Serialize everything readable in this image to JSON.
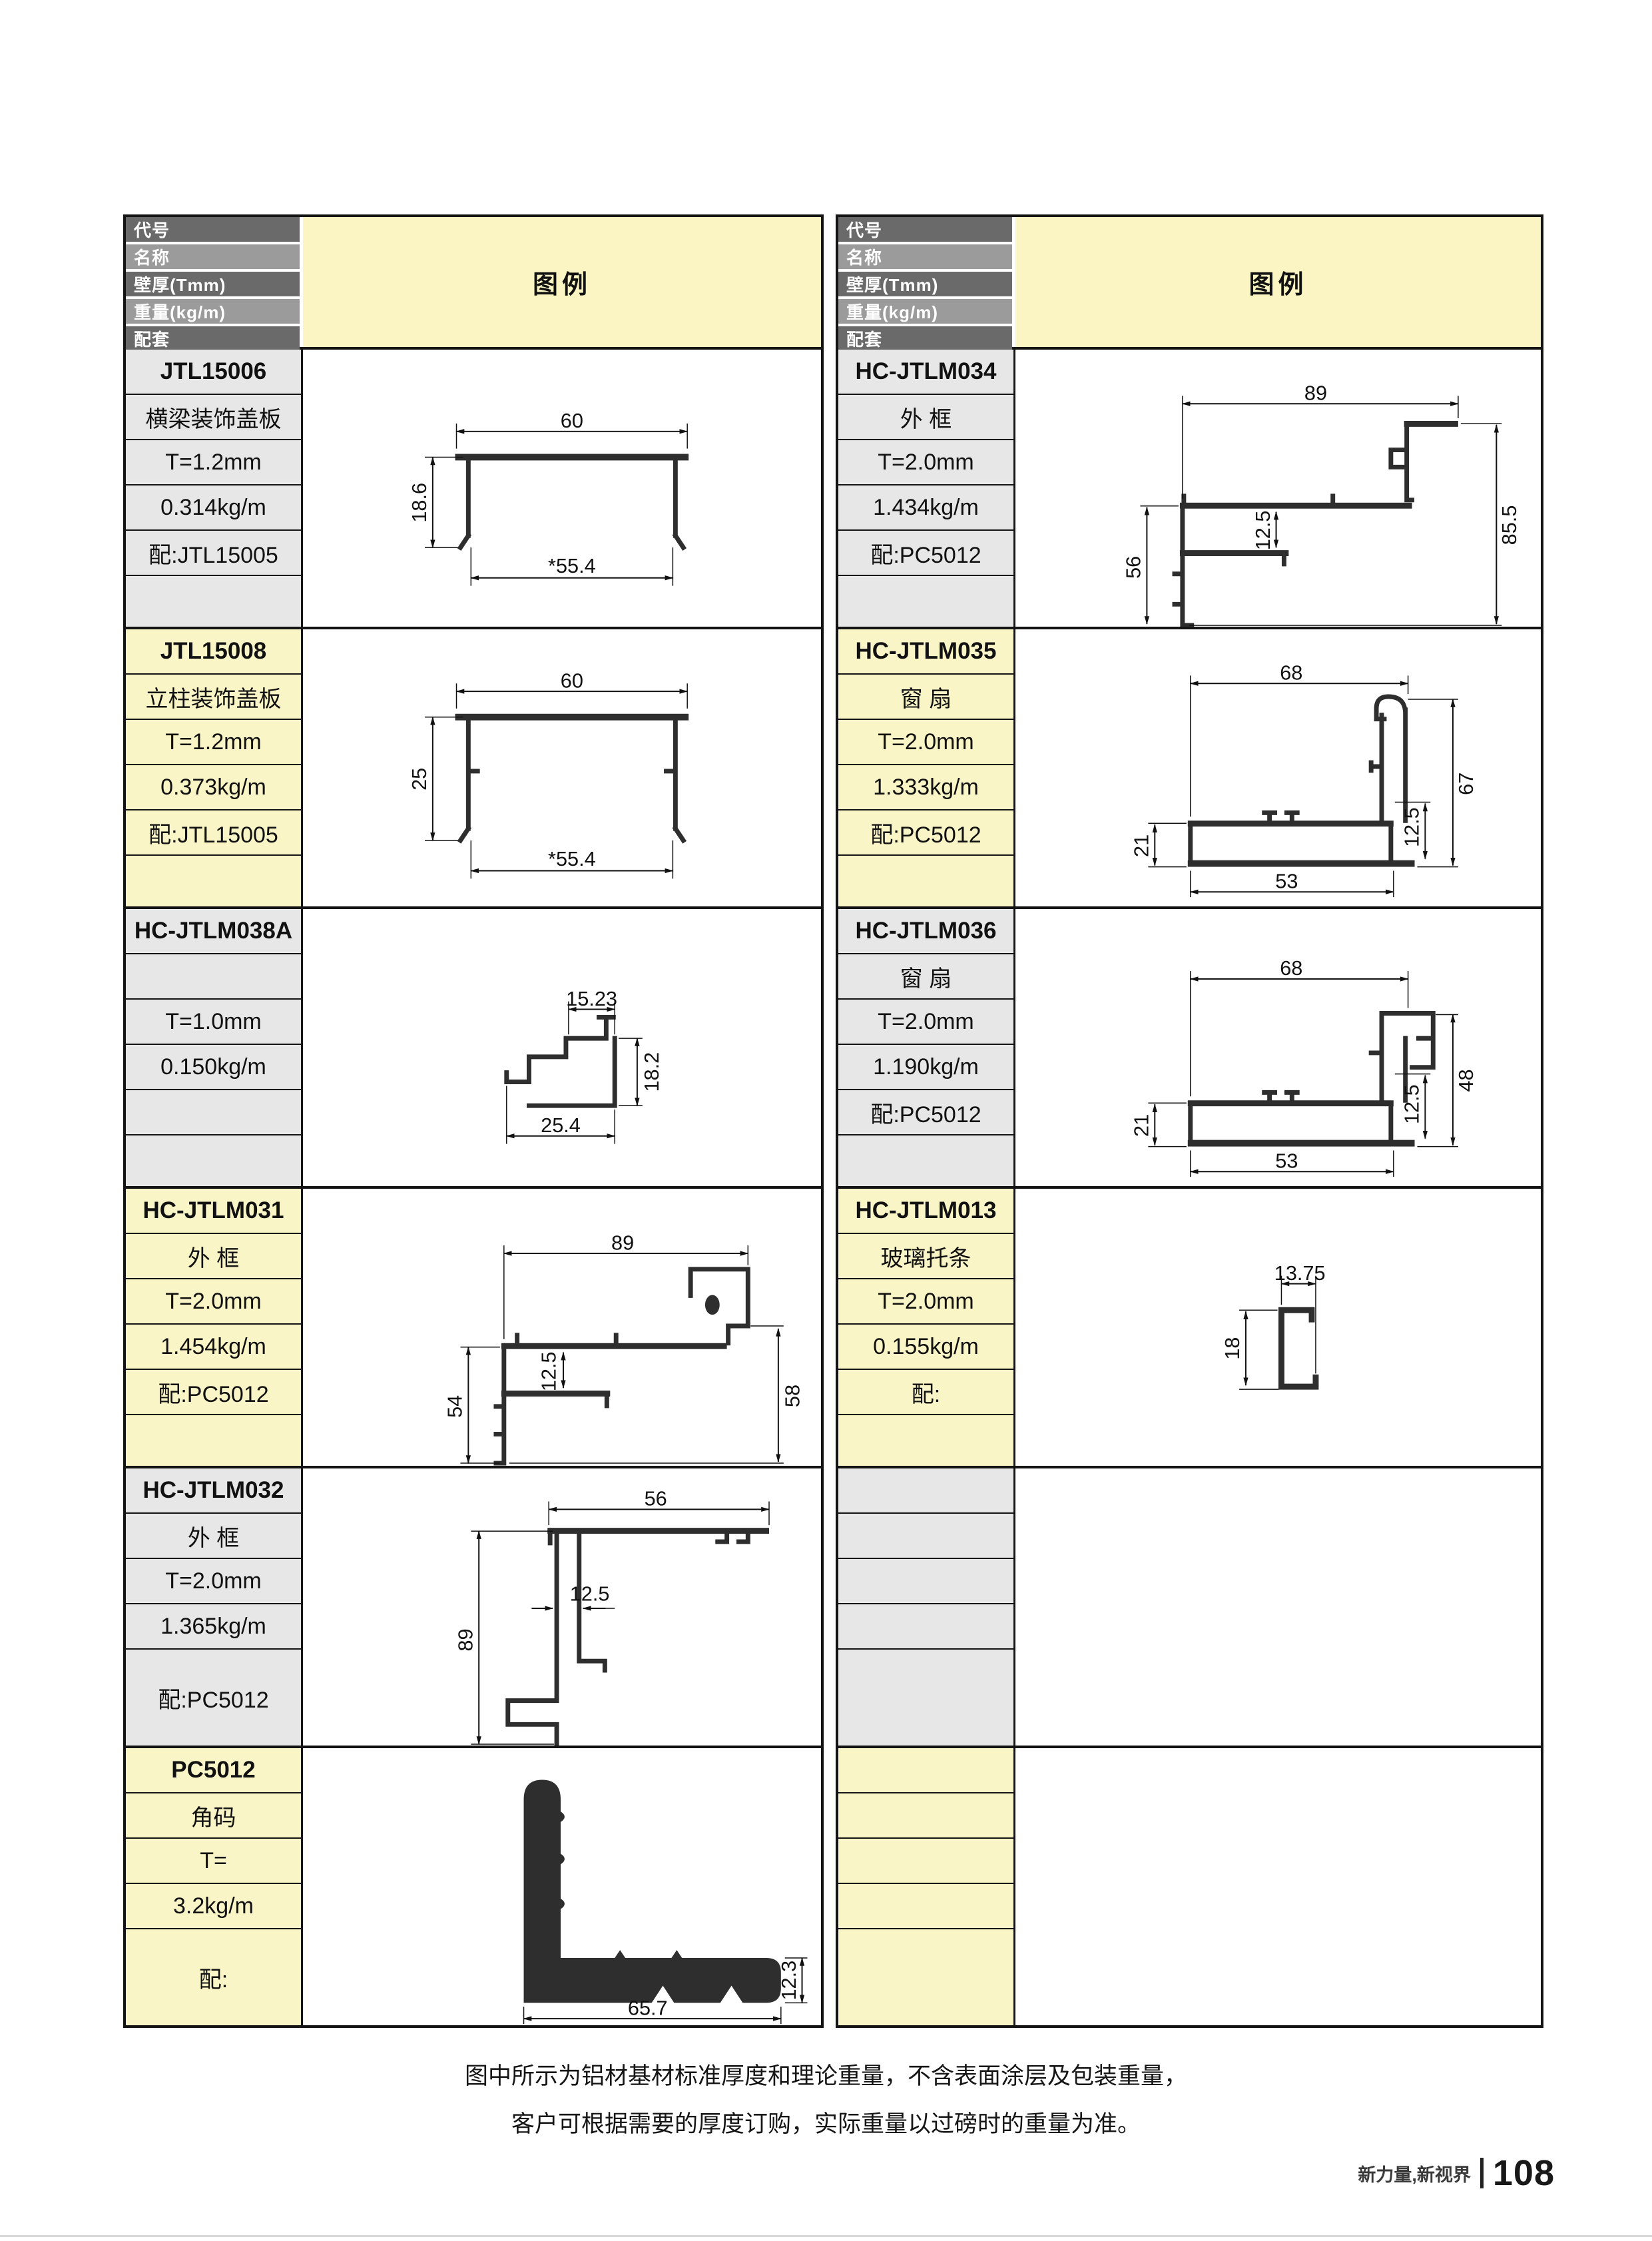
{
  "header": {
    "code": "代号",
    "name": "名称",
    "thickness": "壁厚(Tmm)",
    "weight": "重量(kg/m)",
    "matching": "配套",
    "legend": "图例"
  },
  "left_table": {
    "rows": [
      {
        "code": "JTL15006",
        "name": "横梁装饰盖板",
        "thickness": "T=1.2mm",
        "weight": "0.314kg/m",
        "matching": "配:JTL15005",
        "dims": {
          "d1": "60",
          "d2": "18.6",
          "d3": "*55.4"
        }
      },
      {
        "code": "JTL15008",
        "name": "立柱装饰盖板",
        "thickness": "T=1.2mm",
        "weight": "0.373kg/m",
        "matching": "配:JTL15005",
        "dims": {
          "d1": "60",
          "d2": "25",
          "d3": "*55.4"
        }
      },
      {
        "code": "HC-JTLM038A",
        "name": "",
        "thickness": "T=1.0mm",
        "weight": "0.150kg/m",
        "matching": "",
        "dims": {
          "d1": "15.23",
          "d2": "18.2",
          "d3": "25.4"
        }
      },
      {
        "code": "HC-JTLM031",
        "name": "外 框",
        "thickness": "T=2.0mm",
        "weight": "1.454kg/m",
        "matching": "配:PC5012",
        "dims": {
          "d1": "89",
          "d2": "54",
          "d3": "12.5",
          "d4": "58"
        }
      },
      {
        "code": "HC-JTLM032",
        "name": "外 框",
        "thickness": "T=2.0mm",
        "weight": "1.365kg/m",
        "matching": "配:PC5012",
        "dims": {
          "d1": "56",
          "d2": "12.5",
          "d3": "89"
        }
      },
      {
        "code": "PC5012",
        "name": "角码",
        "thickness": "T=",
        "weight": "3.2kg/m",
        "matching": "配:",
        "dims": {
          "d1": "12.3",
          "d2": "65.7"
        }
      }
    ]
  },
  "right_table": {
    "rows": [
      {
        "code": "HC-JTLM034",
        "name": "外 框",
        "thickness": "T=2.0mm",
        "weight": "1.434kg/m",
        "matching": "配:PC5012",
        "dims": {
          "d1": "89",
          "d2": "12.5",
          "d3": "85.5",
          "d4": "56"
        }
      },
      {
        "code": "HC-JTLM035",
        "name": "窗 扇",
        "thickness": "T=2.0mm",
        "weight": "1.333kg/m",
        "matching": "配:PC5012",
        "dims": {
          "d1": "68",
          "d2": "67",
          "d3": "12.5",
          "d4": "21",
          "d5": "53"
        }
      },
      {
        "code": "HC-JTLM036",
        "name": "窗 扇",
        "thickness": "T=2.0mm",
        "weight": "1.190kg/m",
        "matching": "配:PC5012",
        "dims": {
          "d1": "68",
          "d2": "12.5",
          "d3": "48",
          "d4": "21",
          "d5": "53"
        }
      },
      {
        "code": "HC-JTLM013",
        "name": "玻璃托条",
        "thickness": "T=2.0mm",
        "weight": "0.155kg/m",
        "matching": "配:",
        "dims": {
          "d1": "13.75",
          "d2": "18"
        }
      },
      {
        "code": "",
        "name": "",
        "thickness": "",
        "weight": "",
        "matching": ""
      },
      {
        "code": "",
        "name": "",
        "thickness": "",
        "weight": "",
        "matching": ""
      }
    ]
  },
  "note": {
    "line1": "图中所示为铝材基材标准厚度和理论重量，不含表面涂层及包装重量，",
    "line2": "客户可根据需要的厚度订购，实际重量以过磅时的重量为准。"
  },
  "footer": {
    "slogan": "新力量,新视界",
    "page_number": "108"
  },
  "colors": {
    "legend_bg": "#FAF5C2",
    "row_yellow": "#FAF5C6",
    "row_gray": "#E7E7E7",
    "header_dark": "#6A6A6A",
    "header_mid": "#9B9B9B",
    "border": "#141414"
  }
}
